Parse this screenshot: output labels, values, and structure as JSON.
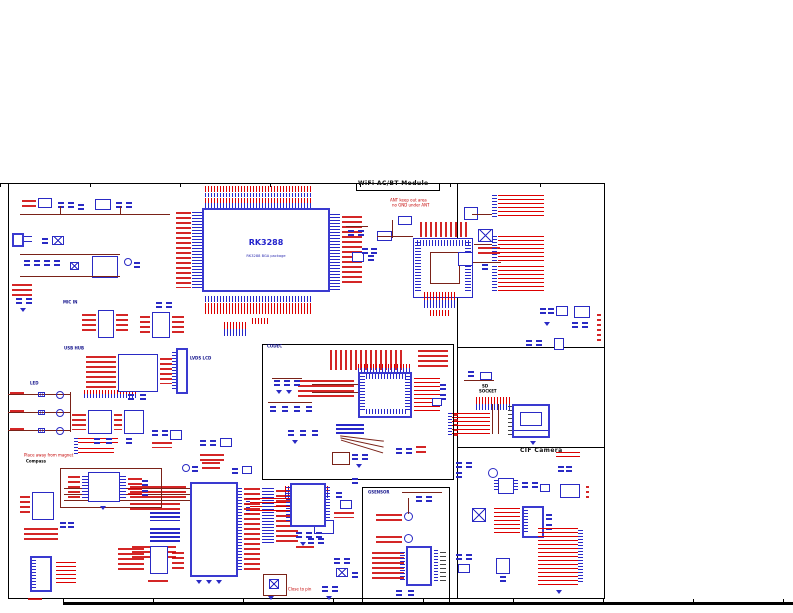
{
  "labels": {
    "sheet_title": "WiFi AC/BT Module",
    "soc_name": "RK3288",
    "soc_package": "RK3288 BGA package",
    "codec": "CODEC",
    "sd_socket_line1": "SD",
    "sd_socket_line2": "SOCKET",
    "cif_camera": "CIF Camera",
    "compass": "Compass",
    "compass_note": "Place away from magnet",
    "led": "LED",
    "usb_hub": "USB HUB",
    "mic_in": "MIC IN",
    "lvds_lcd": "LVDS LCD",
    "gsensor": "GSENSOR",
    "close_to_pin_note": "Close to pin",
    "wifi_note_line1": "ANT keep out area",
    "wifi_note_line2": "no GND under ANT"
  },
  "colors": {
    "signal_red": "#dc0000",
    "component_blue": "#2a2ac4",
    "wire_brown": "#7a2218",
    "chip_text_blue": "#2222cc",
    "frame_black": "#000000"
  }
}
